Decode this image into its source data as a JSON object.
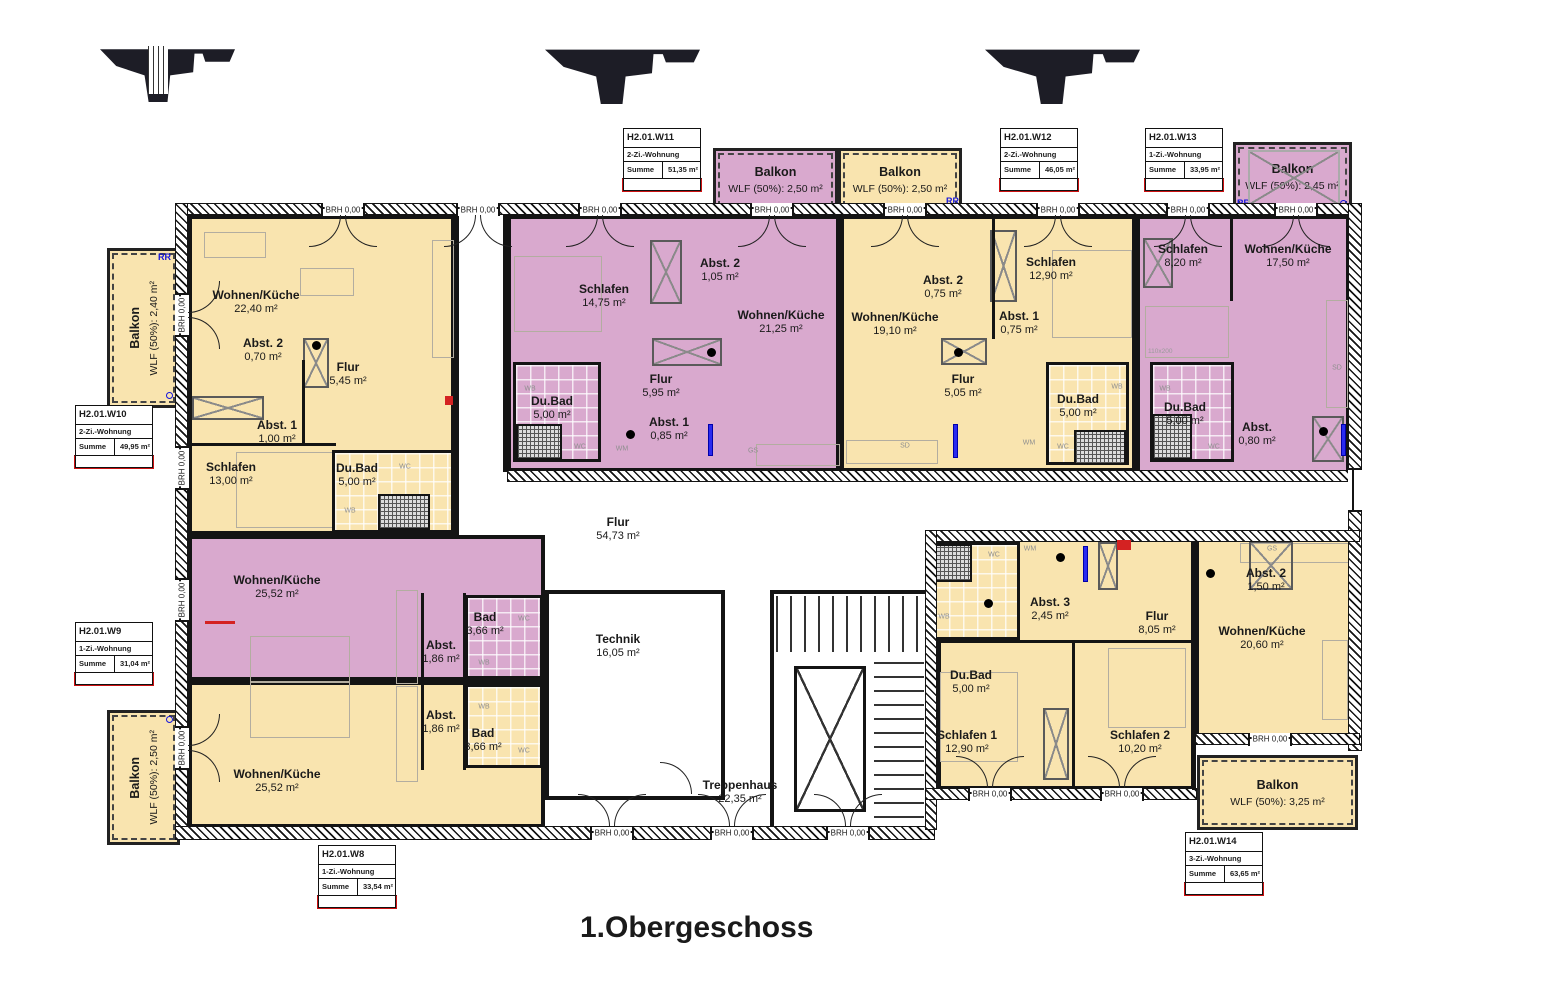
{
  "title": "1.Obergeschoss",
  "labels": {
    "brh": "BRH 0,00",
    "rr": "RR",
    "bed_size": "110x200"
  },
  "fixtures": {
    "wc": "WC",
    "wb": "WB",
    "wm": "WM",
    "gs": "GS",
    "sd": "SD"
  },
  "colors": {
    "apartment_yellow": "#F9E4AF",
    "apartment_purple": "#D9A9CE",
    "wall": "#141414",
    "annotation_blue": "#1414DD",
    "info_red": "#CC1111"
  },
  "info_boxes": {
    "w8": {
      "id": "H2.01.W8",
      "type": "1-Zi.-Wohnung",
      "sum_label": "Summe",
      "sum_value": "33,54 m²"
    },
    "w9": {
      "id": "H2.01.W9",
      "type": "1-Zi.-Wohnung",
      "sum_label": "Summe",
      "sum_value": "31,04 m²"
    },
    "w10": {
      "id": "H2.01.W10",
      "type": "2-Zi.-Wohnung",
      "sum_label": "Summe",
      "sum_value": "49,95 m²"
    },
    "w11": {
      "id": "H2.01.W11",
      "type": "2-Zi.-Wohnung",
      "sum_label": "Summe",
      "sum_value": "51,35 m²"
    },
    "w12": {
      "id": "H2.01.W12",
      "type": "2-Zi.-Wohnung",
      "sum_label": "Summe",
      "sum_value": "46,05 m²"
    },
    "w13": {
      "id": "H2.01.W13",
      "type": "1-Zi.-Wohnung",
      "sum_label": "Summe",
      "sum_value": "33,95 m²"
    },
    "w14": {
      "id": "H2.01.W14",
      "type": "3-Zi.-Wohnung",
      "sum_label": "Summe",
      "sum_value": "63,65 m²"
    }
  },
  "balconies": {
    "left_top": {
      "name": "Balkon",
      "wlf": "WLF (50%): 2,40 m²"
    },
    "left_bottom": {
      "name": "Balkon",
      "wlf": "WLF (50%): 2,50 m²"
    },
    "mid_purple": {
      "name": "Balkon",
      "wlf": "WLF (50%): 2,50 m²"
    },
    "mid_yellow": {
      "name": "Balkon",
      "wlf": "WLF (50%): 2,50 m²"
    },
    "right_top": {
      "name": "Balkon",
      "wlf": "WLF (50%): 2,45 m²"
    },
    "right_bottom": {
      "name": "Balkon",
      "wlf": "WLF (50%): 3,25 m²"
    }
  },
  "rooms": {
    "w10_wohnen": {
      "name": "Wohnen/Küche",
      "area": "22,40 m²"
    },
    "w10_abst2": {
      "name": "Abst. 2",
      "area": "0,70 m²"
    },
    "w10_flur": {
      "name": "Flur",
      "area": "5,45 m²"
    },
    "w10_abst1": {
      "name": "Abst. 1",
      "area": "1,00 m²"
    },
    "w10_schlafen": {
      "name": "Schlafen",
      "area": "13,00 m²"
    },
    "w10_dubad": {
      "name": "Du.Bad",
      "area": "5,00 m²"
    },
    "w11_schlafen": {
      "name": "Schlafen",
      "area": "14,75 m²"
    },
    "w11_abst2": {
      "name": "Abst. 2",
      "area": "1,05 m²"
    },
    "w11_wohnen": {
      "name": "Wohnen/Küche",
      "area": "21,25 m²"
    },
    "w11_flur": {
      "name": "Flur",
      "area": "5,95 m²"
    },
    "w11_dubad": {
      "name": "Du.Bad",
      "area": "5,00 m²"
    },
    "w11_abst1": {
      "name": "Abst. 1",
      "area": "0,85 m²"
    },
    "w12_wohnen": {
      "name": "Wohnen/Küche",
      "area": "19,10 m²"
    },
    "w12_abst2": {
      "name": "Abst. 2",
      "area": "0,75 m²"
    },
    "w12_schlafen": {
      "name": "Schlafen",
      "area": "12,90 m²"
    },
    "w12_abst1": {
      "name": "Abst. 1",
      "area": "0,75 m²"
    },
    "w12_flur": {
      "name": "Flur",
      "area": "5,05 m²"
    },
    "w12_dubad": {
      "name": "Du.Bad",
      "area": "5,00 m²"
    },
    "w13_schlafen": {
      "name": "Schlafen",
      "area": "8,20 m²"
    },
    "w13_wohnen": {
      "name": "Wohnen/Küche",
      "area": "17,50 m²"
    },
    "w13_dubad": {
      "name": "Du.Bad",
      "area": "5,00 m²"
    },
    "w13_abst": {
      "name": "Abst.",
      "area": "0,80 m²"
    },
    "w9_wohnen": {
      "name": "Wohnen/Küche",
      "area": "25,52 m²"
    },
    "w9_bad": {
      "name": "Bad",
      "area": "3,66 m²"
    },
    "w9_abst": {
      "name": "Abst.",
      "area": "1,86 m²"
    },
    "w8_abst": {
      "name": "Abst.",
      "area": "1,86 m²"
    },
    "w8_bad": {
      "name": "Bad",
      "area": "3,66 m²"
    },
    "w8_wohnen": {
      "name": "Wohnen/Küche",
      "area": "25,52 m²"
    },
    "w14_dubad": {
      "name": "Du.Bad",
      "area": "5,00 m²"
    },
    "w14_abst3": {
      "name": "Abst. 3",
      "area": "2,45 m²"
    },
    "w14_flur": {
      "name": "Flur",
      "area": "8,05 m²"
    },
    "w14_abst2": {
      "name": "Abst. 2",
      "area": "1,50 m²"
    },
    "w14_wohnen": {
      "name": "Wohnen/Küche",
      "area": "20,60 m²"
    },
    "w14_schlafen1": {
      "name": "Schlafen 1",
      "area": "12,90 m²"
    },
    "w14_schlafen2": {
      "name": "Schlafen 2",
      "area": "10,20 m²"
    },
    "flur_common": {
      "name": "Flur",
      "area": "54,73 m²"
    },
    "technik": {
      "name": "Technik",
      "area": "16,05 m²"
    },
    "treppenhaus": {
      "name": "Treppenhaus",
      "area": "22,35 m²"
    }
  }
}
